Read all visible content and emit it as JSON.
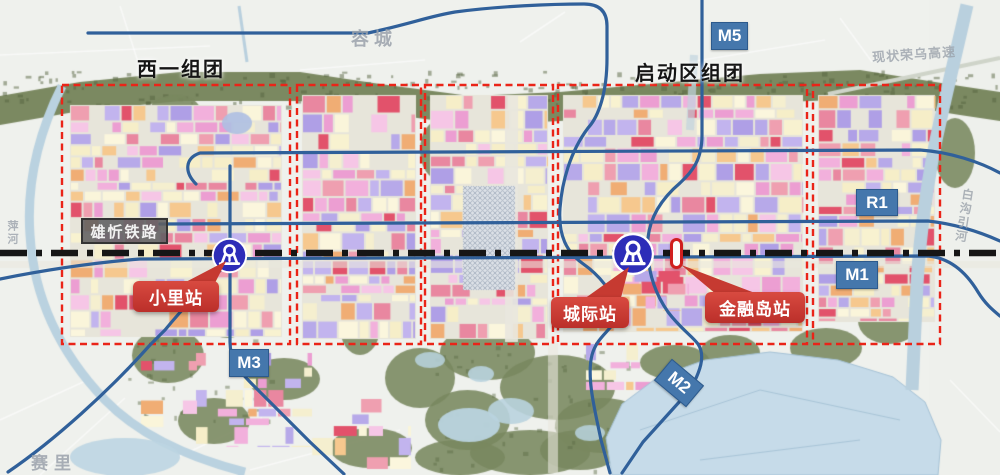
{
  "map": {
    "region_labels": {
      "west": "西一组团",
      "startup": "启动区组团"
    },
    "place_labels": {
      "rongcheng": "容城",
      "rongwu_expressway": "现状荣乌高速",
      "saili": "赛里",
      "pinghe": "萍河",
      "baigou_canal": "白沟引河"
    },
    "railway": {
      "name": "雄忻铁路"
    },
    "stations": [
      {
        "name": "小里站"
      },
      {
        "name": "城际站"
      },
      {
        "name": "金融岛站"
      }
    ],
    "metro_badges": [
      {
        "id": "M5"
      },
      {
        "id": "R1"
      },
      {
        "id": "M1"
      },
      {
        "id": "M3"
      },
      {
        "id": "M2"
      }
    ],
    "colors": {
      "district_outline_red": "#ea2418",
      "callout_red": "#c9342e",
      "badge_blue": "#4577ac",
      "metro_line_blue": "#30609a",
      "railway_black": "#161616",
      "station_icon_blue": "#2d2db8",
      "map_label_gray": "#9aa2ab",
      "water_blue": "#c6dbe9",
      "forest_green": "#74835a"
    }
  }
}
